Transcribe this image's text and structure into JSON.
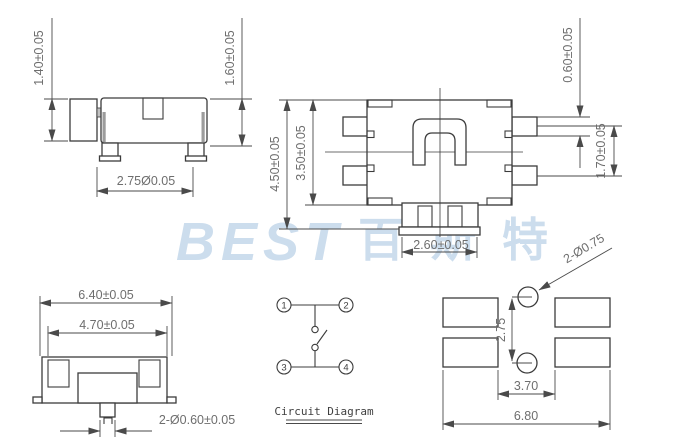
{
  "drawing_title": "Side-actuated SMD tact switch dimensional drawing",
  "colors": {
    "line": "#3c3c3c",
    "dim_text": "#6e6e6e",
    "watermark": "#ccdded",
    "background": "#ffffff"
  },
  "watermark": {
    "latin": "BEST",
    "cjk": "百斯特"
  },
  "views": {
    "side_view": {
      "dims": {
        "actuator_height": "1.40±0.05",
        "body_height": "1.60±0.05",
        "leg_span": "2.75Ø0.05"
      }
    },
    "top_view": {
      "dims": {
        "overall_depth": "4.50±0.05",
        "body_depth": "3.50±0.05",
        "pad_width": "0.60±0.05",
        "pad_pitch": "1.70±0.05",
        "actuator_width": "2.60±0.05"
      }
    },
    "front_view": {
      "dims": {
        "overall_width": "6.40±0.05",
        "body_width": "4.70±0.05",
        "pin_dia": "2-Ø0.60±0.05"
      }
    },
    "circuit": {
      "caption": "Circuit Diagram",
      "pins": [
        "1",
        "2",
        "3",
        "4"
      ]
    },
    "pcb_view": {
      "dims": {
        "hole_dia": "2-Ø0.75",
        "hole_pitch": "2.75",
        "pad_gap": "3.70",
        "overall_width": "6.80"
      }
    }
  }
}
